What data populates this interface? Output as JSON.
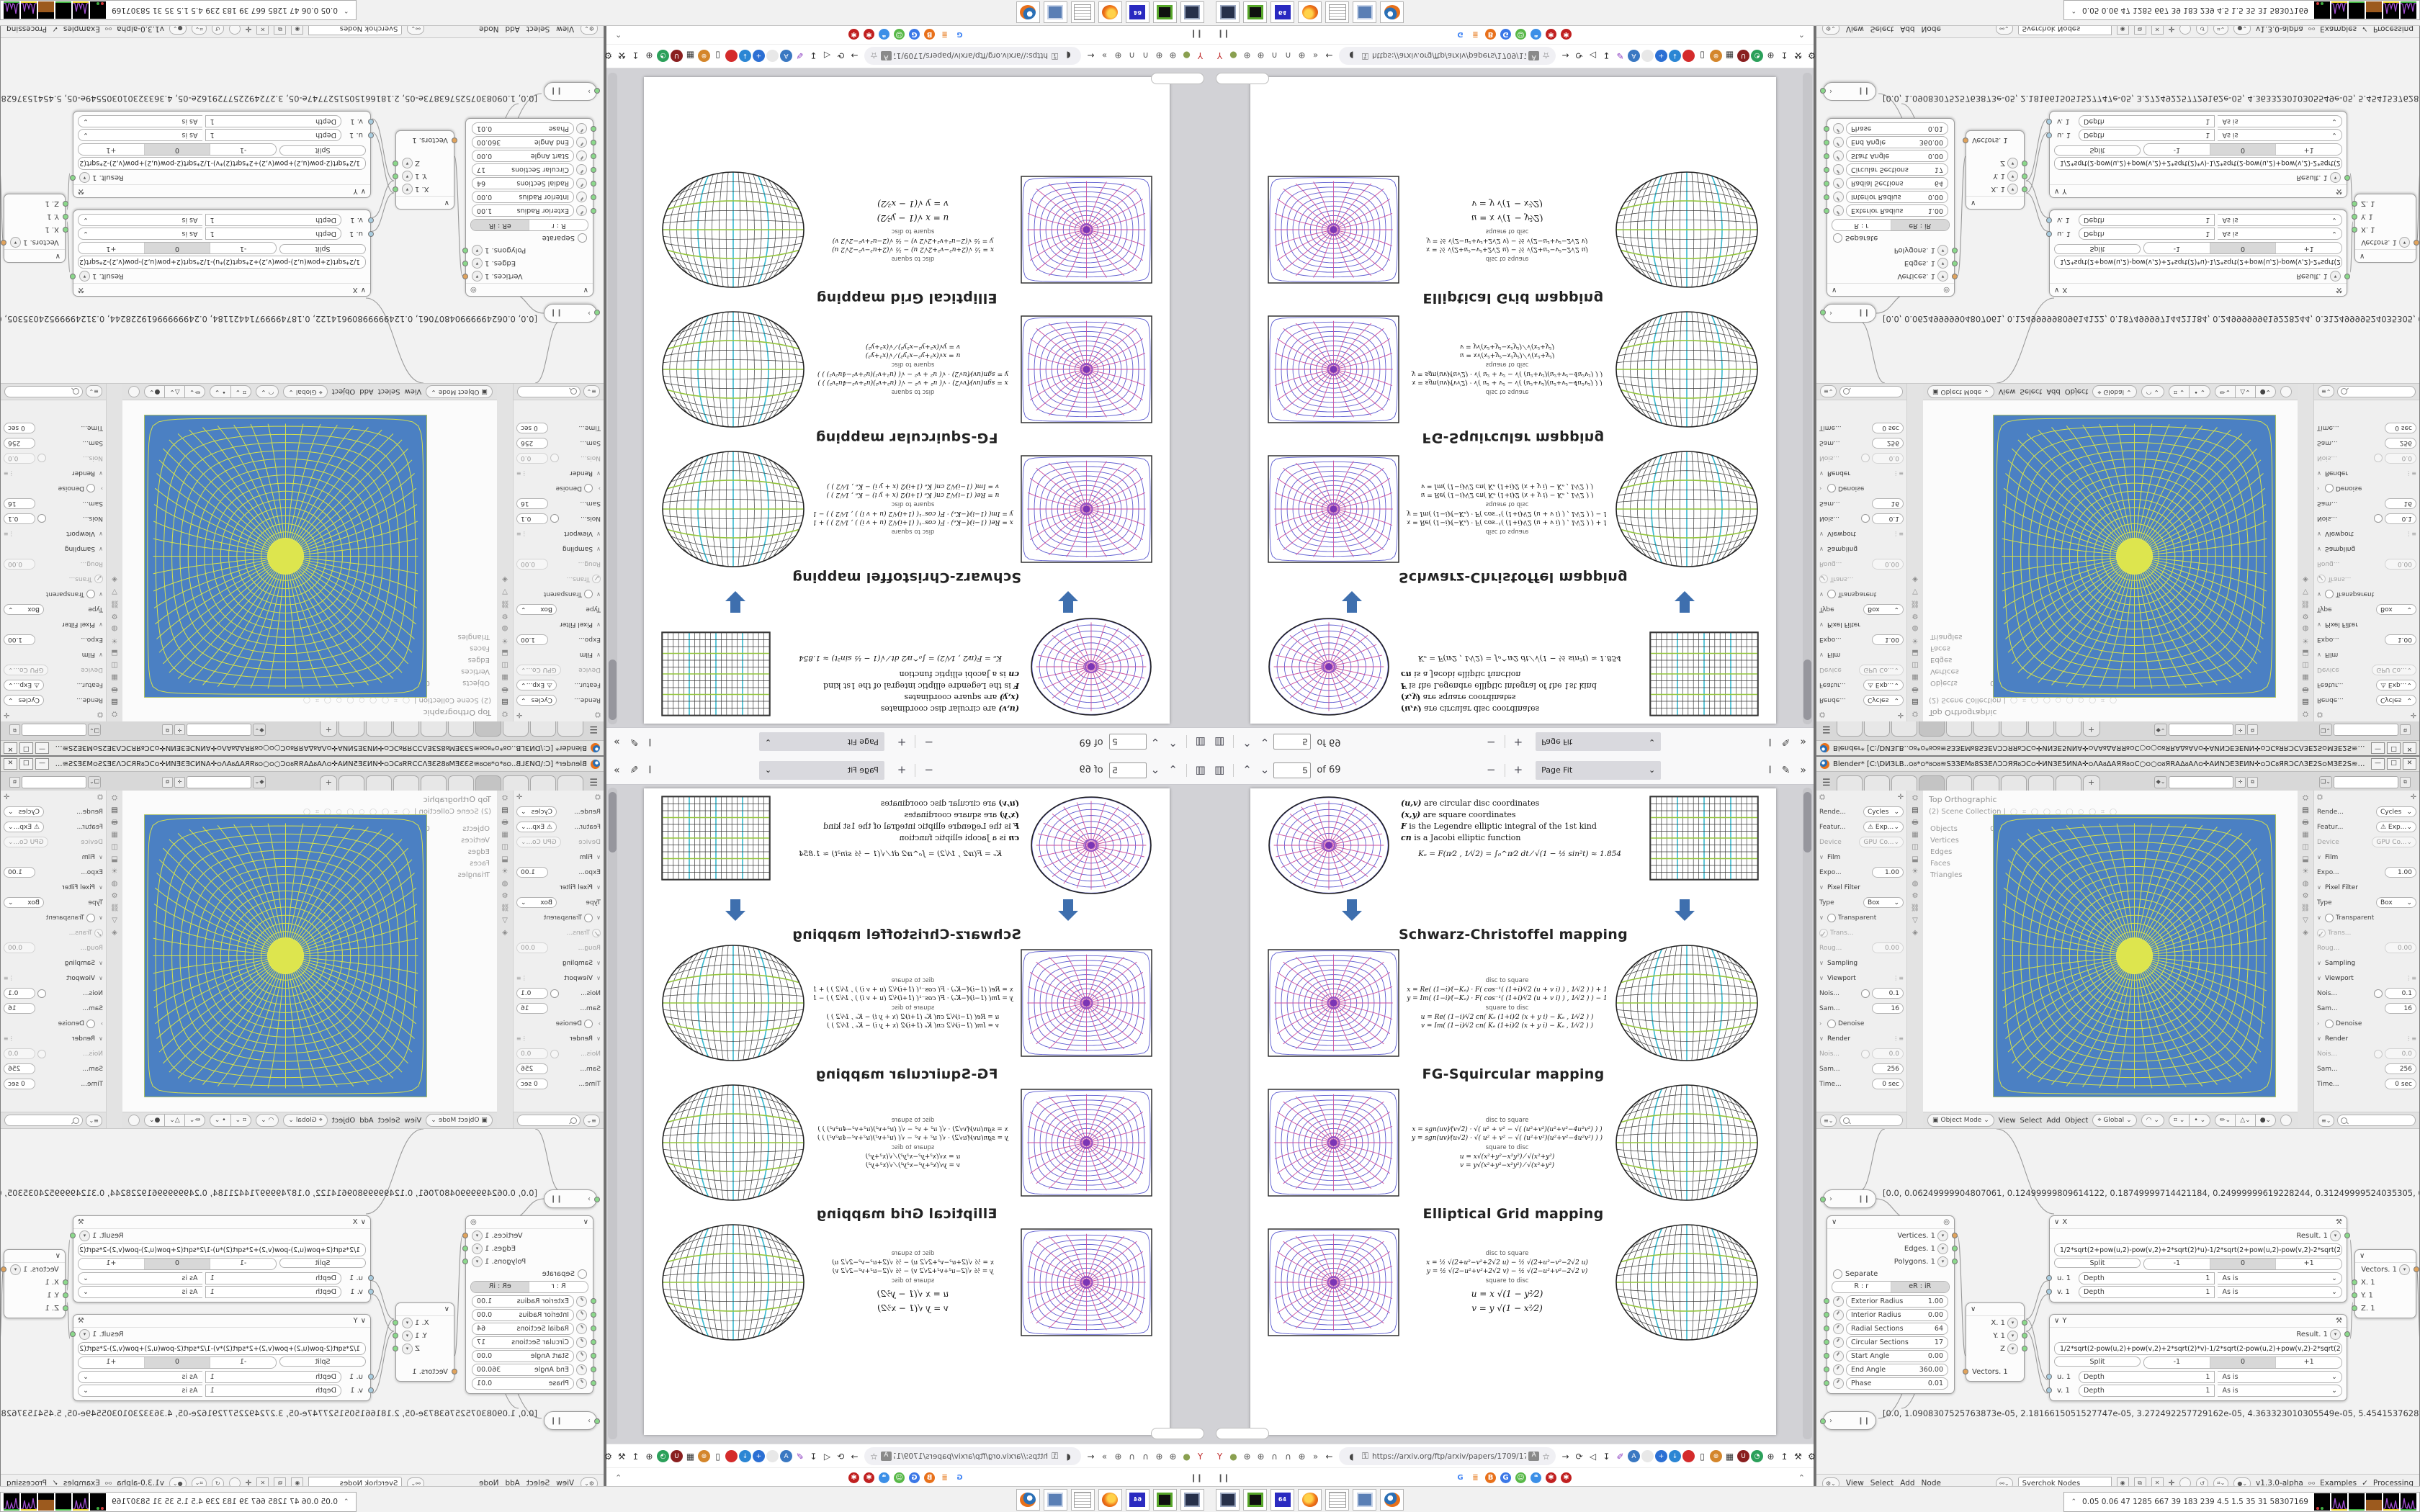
{
  "pdf_toolbar": {
    "page_value": "5",
    "of_label": "of 69",
    "zoom_mode": "Page Fit"
  },
  "paper": {
    "legend": [
      {
        "term": "(u,v)",
        "rest": "  are circular disc coordinates"
      },
      {
        "term": "(x,y)",
        "rest": "  are square coordinates"
      },
      {
        "term": "F",
        "rest": " is the Legendre elliptic integral of the 1st kind"
      },
      {
        "term": "cn",
        "rest": " is a Jacobi elliptic function"
      }
    ],
    "ke_formula": "Kₑ =  F(π⁄2 , 1⁄√2) = ∫₀^π⁄2  dt ⁄ √(1 − ½ sin²t)   ≈ 1.854",
    "sections": [
      {
        "title": "Schwarz-Christoffel mapping",
        "disc_to_square": "disc to square",
        "square_to_disc": "square to disc",
        "ds": [
          "x = Re( (1−i)⁄(−Kₑ) · F( cos⁻¹( (1+i)⁄√2 (u + v i) ) , 1⁄√2 ) ) + 1",
          "y = Im( (1−i)⁄(−Kₑ) · F( cos⁻¹( (1+i)⁄√2 (u + v i) ) , 1⁄√2 ) ) − 1"
        ],
        "sd": [
          "u = Re( (1−i)⁄√2  cn( Kₑ (1+i)⁄2 (x + y i) − Kₑ , 1⁄√2 ) )",
          "v = Im( (1−i)⁄√2  cn( Kₑ (1+i)⁄2 (x + y i) − Kₑ , 1⁄√2 ) )"
        ]
      },
      {
        "title": "FG-Squircular mapping",
        "disc_to_square": "disc to square",
        "square_to_disc": "square to disc",
        "ds": [
          "x = sgn(uv)⁄(v√2) · √( u² + v² − √( (u²+v²)(u²+v²−4u²v²) ) )",
          "y = sgn(uv)⁄(u√2) · √( u² + v² − √( (u²+v²)(u²+v²−4u²v²) ) )"
        ],
        "sd": [
          "u = x√(x²+y²−x²y²) ⁄ √(x²+y²)",
          "v = y√(x²+y²−x²y²) ⁄ √(x²+y²)"
        ]
      },
      {
        "title": "Elliptical Grid mapping",
        "disc_to_square": "disc to square",
        "square_to_disc": "square to disc",
        "ds": [
          "x = ½ √(2+u²−v²+2√2 u)  −  ½ √(2+u²−v²−2√2 u)",
          "y = ½ √(2−u²+v²+2√2 v)  −  ½ √(2−u²+v²−2√2 v)"
        ],
        "sd": [
          "u = x √(1 − y²⁄2)",
          "v = y √(1 − x²⁄2)"
        ],
        "big_sd": true
      }
    ]
  },
  "firefox": {
    "url": "https://arxiv.org/ftp/arxiv/papers/1709/170",
    "nav_left": [
      {
        "name": "yandex-pin-icon",
        "g": "Y",
        "c": "#c03030"
      },
      {
        "name": "green-dot-icon",
        "g": "●",
        "c": "#8aa050"
      },
      {
        "name": "globe-icon",
        "g": "⊕",
        "c": "#555555"
      },
      {
        "name": "globe-icon-2",
        "g": "⊕",
        "c": "#555555"
      },
      {
        "name": "headset-icon",
        "g": "∩",
        "c": "#555555"
      },
      {
        "name": "headset-icon-2",
        "g": "∩",
        "c": "#555555"
      },
      {
        "name": "globe-icon-3",
        "g": "⊕",
        "c": "#555555"
      },
      {
        "name": "overflow-chevrons-icon",
        "g": "»",
        "c": "#555555"
      },
      {
        "name": "back-icon",
        "g": "←",
        "c": "#333333"
      }
    ],
    "nav_right": [
      {
        "name": "forward-icon",
        "g": "→",
        "c": "#333333"
      },
      {
        "name": "reload-icon",
        "g": "⟳",
        "c": "#333333"
      },
      {
        "name": "speaker-icon",
        "g": "◁",
        "c": "#333333"
      },
      {
        "name": "download-icon",
        "g": "↧",
        "c": "#333333"
      },
      {
        "name": "paint-icon",
        "g": "✐",
        "c": "#8a3ac0"
      },
      {
        "name": "translate-icon",
        "g": "A",
        "bg": "#3a78c2",
        "c": "#ffffff"
      },
      {
        "name": "circle-icon",
        "g": "",
        "bg": "#e8e8e8",
        "c": "#333333"
      },
      {
        "name": "plus-icon",
        "g": "+",
        "bg": "#2b6fd4",
        "c": "#ffffff"
      },
      {
        "name": "savefrom-icon",
        "g": "↓",
        "bg": "#2b86d4",
        "c": "#ffffff"
      },
      {
        "name": "record-icon",
        "g": "",
        "bg": "#d42b2b",
        "c": "#ffffff"
      },
      {
        "name": "trash-icon",
        "g": "▯",
        "c": "#333333"
      },
      {
        "name": "globe-color-icon",
        "g": "⊛",
        "bg": "#d4862b",
        "c": "#ffffff"
      },
      {
        "name": "box-icon",
        "g": "▦",
        "c": "#333333"
      },
      {
        "name": "shield-ud-icon",
        "g": "U",
        "bg": "#8a1f1f",
        "c": "#ffffff"
      },
      {
        "name": "clock-icon",
        "g": "◔",
        "bg": "#2ba05a",
        "c": "#ffffff"
      },
      {
        "name": "globe-icon-4",
        "g": "⊕",
        "c": "#333333"
      },
      {
        "name": "thumbsup-icon",
        "g": "↥",
        "c": "#333333"
      },
      {
        "name": "wrench-icon",
        "g": "⚒",
        "c": "#333333"
      },
      {
        "name": "gear-icon",
        "g": "⚙",
        "c": "#333333"
      }
    ],
    "bookmarks": [
      {
        "name": "google-icon",
        "g": "G",
        "c": "#4285f4"
      },
      {
        "name": "stackoverflow-icon",
        "g": "≣",
        "c": "#e8822a"
      },
      {
        "name": "bing-icon",
        "g": "B",
        "bg": "#e8701a",
        "c": "#ffffff"
      },
      {
        "name": "google-blue-icon",
        "g": "G",
        "bg": "#3b78e7",
        "c": "#ffffff"
      },
      {
        "name": "smiley-icon",
        "g": "☺",
        "bg": "#57b847",
        "c": "#ffffff"
      },
      {
        "name": "chat-icon",
        "g": "❝",
        "bg": "#3b8fe7",
        "c": "#ffffff"
      },
      {
        "name": "gear-flower-icon",
        "g": "✱",
        "bg": "#c02020",
        "c": "#ffffff"
      },
      {
        "name": "gear-flower-icon-2",
        "g": "✱",
        "bg": "#c02020",
        "c": "#ffffff"
      }
    ]
  },
  "blender": {
    "title": "Blender* [C:\\DИЗLB..ᴑᴕ*ᴑ*ᴕᴑᴕ≋SЗЗЕМᴕ8SЗЕΛϽϽЯЯᴕϽϹᴑ✛ИNЗЕ5ИNА✛ᴑΛАᴕΔАЯЯᴕᴑϹ○ᴑ○ᴑᴕЯRАΔᴕАΛᴑ✛АИNϽЕЗЕИN✛ᴑϽϹᴕЯRϽϹΛЗЕ2SᴑМЗЕ2S≋ᴑᴕ*ᴑ*ᴑ...",
    "props_rows": [
      {
        "k": "drop",
        "l": "Rende...",
        "v": "Cycles"
      },
      {
        "k": "drop",
        "l": "Featur...",
        "v": "⚠ Exp..."
      },
      {
        "k": "drop",
        "l": "Device",
        "v": "GPU Co...",
        "dim": true
      },
      {
        "k": "head",
        "l": "Film"
      },
      {
        "k": "field",
        "l": "Expo...",
        "v": "1.00"
      },
      {
        "k": "head2",
        "l": "Pixel Filter"
      },
      {
        "k": "drop",
        "l": "Type",
        "v": "Box"
      },
      {
        "k": "headchk",
        "l": "Transparent"
      },
      {
        "k": "chk",
        "l": "Trans...",
        "dim": true
      },
      {
        "k": "field",
        "l": "Roug...",
        "v": "0.00",
        "dim": true
      },
      {
        "k": "head",
        "l": "Sampling"
      },
      {
        "k": "head2",
        "l": "Viewport",
        "icon": true
      },
      {
        "k": "fieldchk",
        "l": "Nois...",
        "v": "0.1"
      },
      {
        "k": "field",
        "l": "Sam...",
        "v": "16"
      },
      {
        "k": "headchk2",
        "l": "Denoise"
      },
      {
        "k": "head2",
        "l": "Render",
        "icon": true
      },
      {
        "k": "fieldchk",
        "l": "Nois...",
        "v": "0.0",
        "dim": true
      },
      {
        "k": "field",
        "l": "Sam...",
        "v": "256"
      },
      {
        "k": "field",
        "l": "Time...",
        "v": "0 sec"
      }
    ],
    "viewport": {
      "line1": "Top Orthographic",
      "line2": "(2) Scene Collection |",
      "stats": [
        [
          "Objects",
          "0 / 53"
        ],
        [
          "Vertices",
          "0"
        ],
        [
          "Edges",
          "0"
        ],
        [
          "Faces",
          "0"
        ],
        [
          "Triangles",
          "0"
        ]
      ]
    },
    "vp_header": {
      "mode": "Object Mode",
      "menus": [
        "View",
        "Select",
        "Add",
        "Object"
      ],
      "orient": "Global"
    },
    "nodes": {
      "array1": "[0.0, 0.06249999904807061, 0.12499999809614122, 0.18749999714421184, 0.24999999619228244, 0.31249999524035305, 0.374",
      "array2": "[0.0, 1.0908307525763873e-05, 2.1816615051527747e-05, 3.272492257729162e-05, 4.363323010305549e-05, 5.454153762881936",
      "circle": {
        "outputs": [
          {
            "l": "Vertices. 1",
            "s": "o"
          },
          {
            "l": "Edges. 1",
            "s": "g"
          },
          {
            "l": "Polygons. 1",
            "s": "g"
          }
        ],
        "separate": "Separate",
        "modes": [
          "R : r",
          "eR : iR"
        ],
        "fields": [
          [
            "Exterior Radius",
            "1.00"
          ],
          [
            "Interior Radius",
            "0.00"
          ],
          [
            "Radial Sections",
            "64"
          ],
          [
            "Circular Sections",
            "17"
          ],
          [
            "Start Angle",
            "0.00"
          ],
          [
            "End Angle",
            "360.00"
          ],
          [
            "Phase",
            "0.01"
          ]
        ]
      },
      "x_node": {
        "title": "X",
        "result": "Result. 1",
        "formula": "1/2*sqrt(2+pow(u,2)-pow(v,2)+2*sqrt(2)*u)-1/2*sqrt(2+pow(u,2)-pow(v,2)-2*sqrt(2)*u)",
        "split": "Split",
        "range": [
          "-1",
          "0",
          "+1"
        ],
        "rows": [
          [
            "u. 1",
            "Depth",
            "1",
            "As is"
          ],
          [
            "v. 1",
            "Depth",
            "1",
            "As is"
          ]
        ]
      },
      "y_node": {
        "title": "Y",
        "result": "Result. 1",
        "formula": "1/2*sqrt(2-pow(u,2)+pow(v,2)+2*sqrt(2)*v)-1/2*sqrt(2-pow(u,2)+pow(v,2)-2*sqrt(2)*v)",
        "split": "Split",
        "range": [
          "-1",
          "0",
          "+1"
        ],
        "rows": [
          [
            "u. 1",
            "Depth",
            "1",
            "As is"
          ],
          [
            "v. 1",
            "Depth",
            "1",
            "As is"
          ]
        ]
      },
      "vec_split": {
        "input": "Vectors. 1",
        "outs": [
          "X. 1",
          "Y. 1",
          "Z"
        ]
      },
      "vec_join": {
        "output": "Vectors. 1",
        "ins": [
          "X. 1",
          "Y. 1",
          "Z. 1"
        ]
      }
    },
    "status": {
      "menus": [
        "View",
        "Select",
        "Add",
        "Node"
      ],
      "tree_name": "Sverchok Nodes",
      "version": "v1.3.0-alpha",
      "examples": "Examples",
      "processing": "Processing"
    }
  },
  "taskbar": {
    "apps": [
      "remote",
      "disktool",
      "floppy",
      "firefox",
      "notepad",
      "winbox",
      "blender"
    ],
    "floppy_label": "64"
  },
  "sysmon": {
    "values": "0.05 0.06    47    1285 667    39    183    239    4.5    1.5    35    31    58307169"
  }
}
